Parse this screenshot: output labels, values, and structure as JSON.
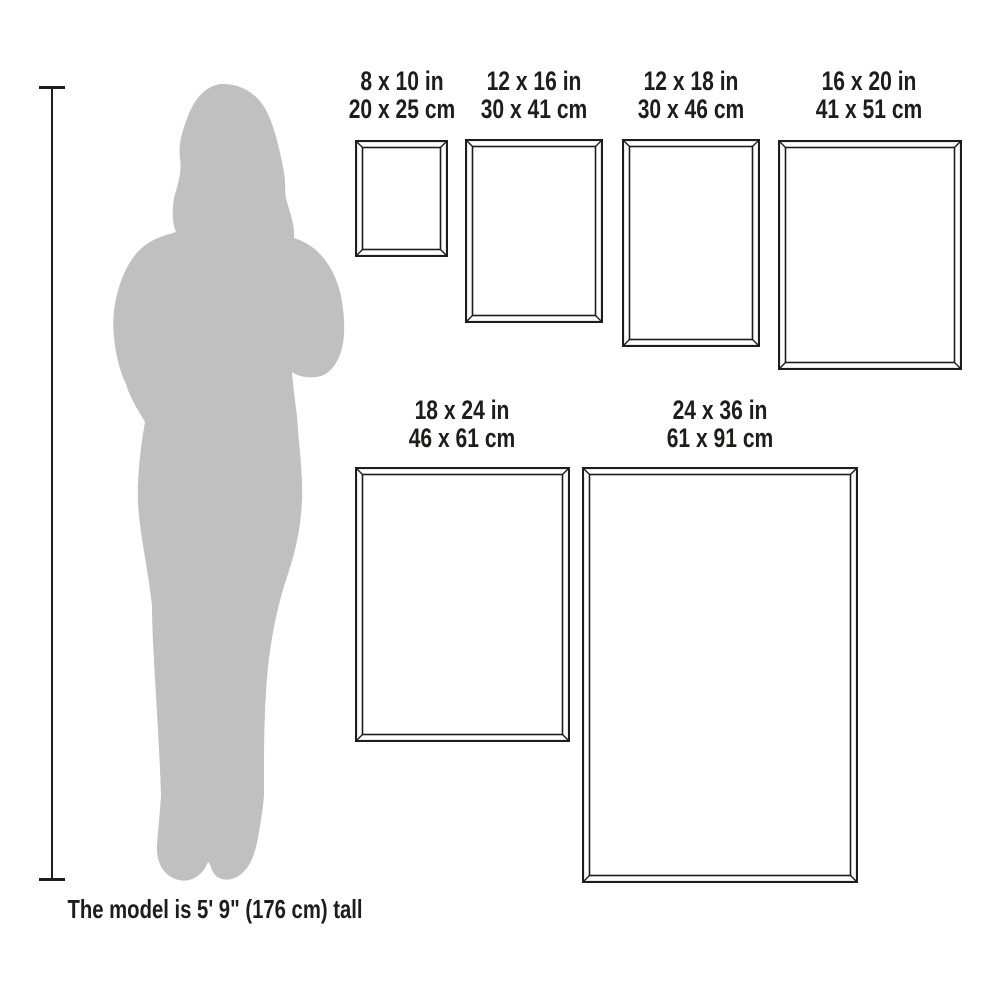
{
  "page": {
    "background": "#ffffff"
  },
  "colors": {
    "line": "#1d1d1b",
    "text": "#1d1d1b",
    "silhouette": "#c0c0c0",
    "background": "#ffffff"
  },
  "frames": [
    {
      "name": "8x10",
      "label_in": "8 x 10 in",
      "label_cm": "20 x 25 cm"
    },
    {
      "name": "12x16",
      "label_in": "12 x 16 in",
      "label_cm": "30 x 41 cm"
    },
    {
      "name": "12x18",
      "label_in": "12 x 18 in",
      "label_cm": "30 x 46 cm"
    },
    {
      "name": "16x20",
      "label_in": "16 x 20 in",
      "label_cm": "41 x 51 cm"
    },
    {
      "name": "18x24",
      "label_in": "18 x 24 in",
      "label_cm": "46 x 61 cm"
    },
    {
      "name": "24x36",
      "label_in": "24 x 36 in",
      "label_cm": "61 x 91 cm"
    }
  ],
  "model": {
    "caption": "The model is 5' 9\" (176 cm) tall"
  }
}
